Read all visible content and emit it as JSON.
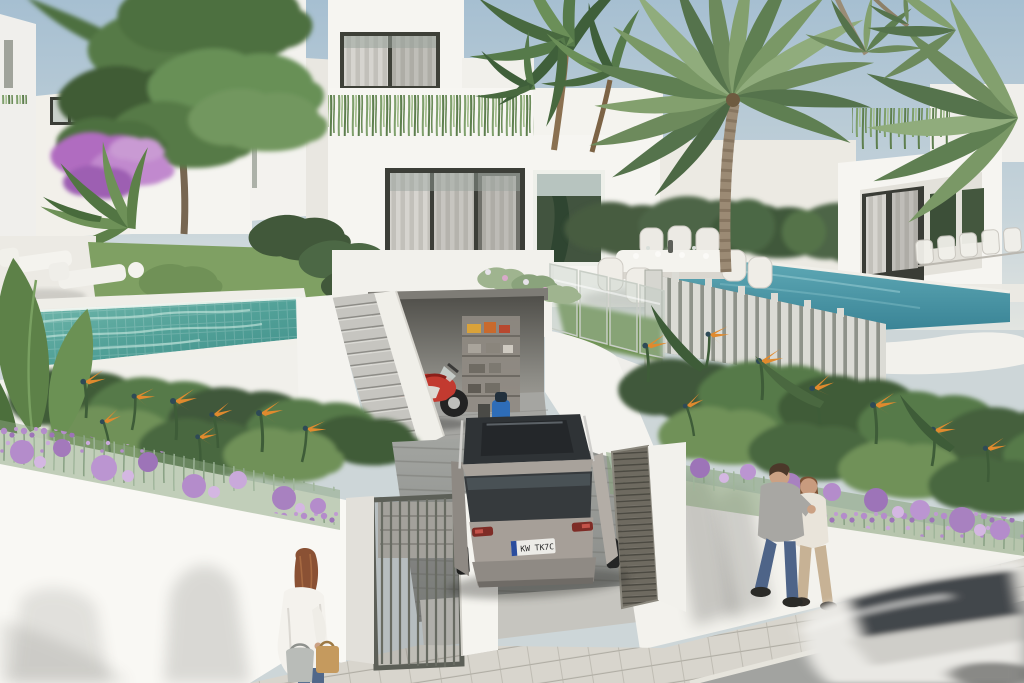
{
  "scene": {
    "title": "Architectural 3D render — modern white villas with private pools, street-side view",
    "environment": {
      "sky": "pale hazy blue, bright daylight",
      "style": "photoreal CGI exterior visualization"
    },
    "license_plate": {
      "text": "KW TK7C",
      "eu_strip": true
    }
  },
  "palette": {
    "sky_top": "#a6bfd1",
    "sky_horizon": "#e2e5e1",
    "wall_sunlit": "#f7f6f1",
    "wall_bright": "#fbfaf6",
    "wall_shade": "#e0ded7",
    "pool_left_teal": "#52a198",
    "pool_right_blue": "#4798a9",
    "lawn": "#7fa063",
    "foliage_dark": "#41583a",
    "foliage_mid": "#5f7f52",
    "foliage_light": "#8fac7c",
    "flower_purple": "#b48ccb",
    "flower_orange": "#e08a2e",
    "sidewalk": "#d8d5cd",
    "driveway": "#96989​4",
    "street": "#a2a3a0",
    "suv_silver": "#a69f98",
    "glass_dark": "#363a3d",
    "motorcycle_red": "#c23a30",
    "gate_metal": "#5c5f57",
    "skin": "#cba184",
    "jeans_blue": "#4e6488"
  },
  "elements": {
    "sky": "clear pale sky",
    "buildings": [
      {
        "name": "villa-left-background",
        "desc": "white two-storey villa with dark framed window, left distance"
      },
      {
        "name": "villa-central",
        "desc": "two-storey white villa: roof terrace with trailing planters, curtained glazing, street-level garage"
      },
      {
        "name": "villa-right",
        "desc": "white villa with deep framed terrace, curtained sliders, clipped hedge screens"
      },
      {
        "name": "background-houses",
        "desc": "hazy white neighbouring houses behind palms"
      }
    ],
    "pools": [
      {
        "name": "pool-left",
        "desc": "turquoise mosaic-tiled pool, white deck, two sun loungers"
      },
      {
        "name": "pool-right",
        "desc": "blue pool behind white slatted fence, white outdoor dining set on terrace"
      }
    ],
    "vegetation": [
      {
        "name": "palm-tree-large",
        "desc": "tall palm in front of right villa"
      },
      {
        "name": "palms-leaning",
        "desc": "thin leaning palm trunks crossing the sky"
      },
      {
        "name": "dracaena-cluster",
        "desc": "tropical dracaena heads beside central villa"
      },
      {
        "name": "garden-tree",
        "desc": "leafy green tree in left garden"
      },
      {
        "name": "bougainvillea",
        "desc": "purple bougainvillea on left garden wall"
      },
      {
        "name": "flower-wall-left",
        "desc": "white street wall draped with purple trailing flowers"
      },
      {
        "name": "flower-wall-right",
        "desc": "white street wall draped with purple trailing flowers"
      },
      {
        "name": "bird-of-paradise-beds",
        "desc": "dense beds with orange strelitzia blooms"
      },
      {
        "name": "banana-leaves",
        "desc": "large paddle leaves at far left"
      },
      {
        "name": "parapet-planters",
        "desc": "green plants cascading from roof parapets"
      },
      {
        "name": "hedges-lawn",
        "desc": "clipped hedges and lawns between plots"
      }
    ],
    "vehicles": [
      {
        "name": "suv",
        "desc": "silver SUV with panoramic glass roof parked on sloped driveway, EU plate"
      },
      {
        "name": "motorcycle",
        "desc": "red sport motorcycle parked in open garage"
      },
      {
        "name": "car-motion-blur",
        "desc": "white car passing on street, motion blurred, bottom right"
      }
    ],
    "people": [
      {
        "name": "couple-walking",
        "desc": "man in grey tee and jeans arm-in-arm with woman in cream top, walking on sidewalk"
      },
      {
        "name": "woman-with-bags",
        "desc": "auburn-haired woman in white cardigan and jeans carrying two bags, bottom left"
      }
    ],
    "structures": [
      {
        "name": "garage",
        "desc": "open garage bay with storage shelving and blue cleaner"
      },
      {
        "name": "stairs",
        "desc": "grey concrete stair between white walls up to pool garden"
      },
      {
        "name": "glass-balustrade",
        "desc": "frameless glass balustrade over garage terrace"
      },
      {
        "name": "slat-fence",
        "desc": "white vertical-slat pool fence"
      },
      {
        "name": "pedestrian-gate",
        "desc": "dark metal barred gate between white piers"
      },
      {
        "name": "louvre-door",
        "desc": "dark louvred service door in right wall"
      },
      {
        "name": "driveway",
        "desc": "grey paver ramp from garage to street"
      },
      {
        "name": "sidewalk",
        "desc": "light stone paver sidewalk"
      },
      {
        "name": "street",
        "desc": "asphalt-grey street, bottom right corner"
      }
    ]
  }
}
